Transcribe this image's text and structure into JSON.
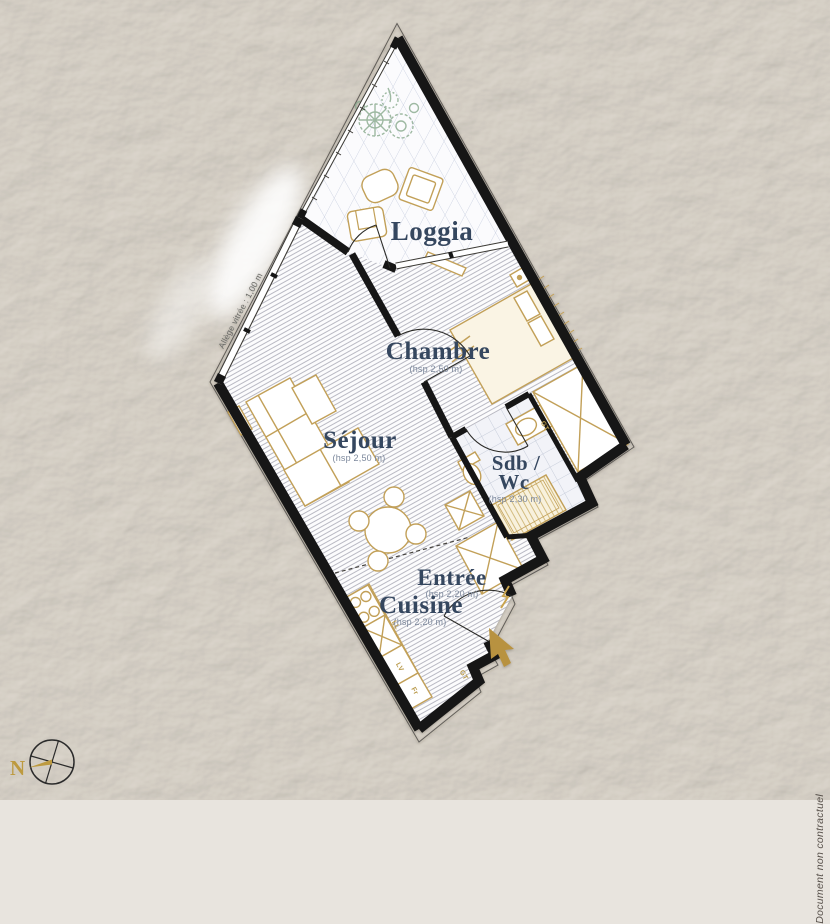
{
  "rooms": {
    "loggia": {
      "label": "Loggia"
    },
    "chambre": {
      "label": "Chambre",
      "height_note": "(hsp 2,50 m)"
    },
    "sejour": {
      "label": "Séjour",
      "height_note": "(hsp 2,50 m)"
    },
    "sdb_wc": {
      "label_line1": "Sdb /",
      "label_line2": "Wc",
      "height_note": "(hsp 2,30 m)"
    },
    "entree": {
      "label": "Entrée",
      "height_note": "(hsp 2,20 m)"
    },
    "cuisine": {
      "label": "Cuisine",
      "height_note": "(hsp 2,20 m)"
    }
  },
  "annotations": {
    "window_note": "Allège vitrée : 1,00 m",
    "disclaimer": "Document non contractuel",
    "north_label": "N",
    "appliance_ll": "LL",
    "appliance_lv": "LV",
    "appliance_fr": "Fr",
    "meter_gt": "GT"
  },
  "colors": {
    "paper": "#e8e4de",
    "wall": "#141414",
    "furniture_gold": "#c2a058",
    "label_navy": "#36465f",
    "height_note_gray": "#7c889c",
    "plant_green": "#87a98c",
    "tile_line": "#ccd2e2",
    "hatch_line": "#b9b9c3"
  }
}
